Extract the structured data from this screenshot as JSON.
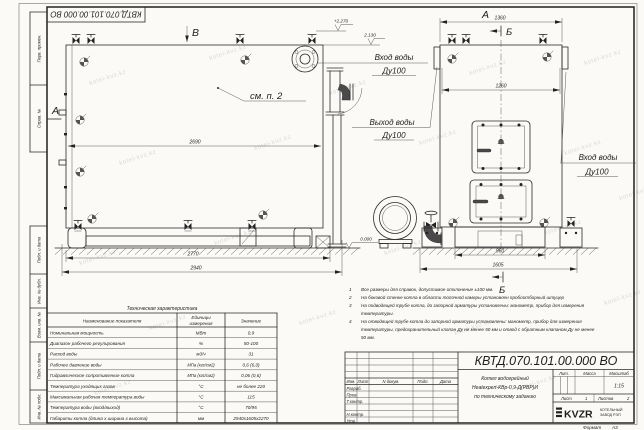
{
  "watermark": {
    "text": "kotel-kvz.kz"
  },
  "stamp_top": "КВТД.070.101.00.000 ВО",
  "margin": {
    "labels": [
      "Перв. примен.",
      "Справ. №",
      "Подп. и дата",
      "Инв. № дубл.",
      "Взам. инв. №",
      "Подп. и дата",
      "Инв. № подл."
    ]
  },
  "views": {
    "label_a_left": "А",
    "label_v_top": "В",
    "label_a_right": "А",
    "label_b_top": "Б",
    "label_b_bottom": "Б",
    "see_note": "см. п. 2"
  },
  "levels": {
    "top": "+2.270",
    "inlet": "2.130",
    "ground": "0.000"
  },
  "dims": {
    "d2690": "2690",
    "d2770": "2770",
    "d2940": "2940",
    "d1360": "1360",
    "d1260": "1260",
    "d960": "960",
    "d1605": "1605"
  },
  "ports": {
    "inlet_left": {
      "line1": "Вход воды",
      "line2": "Ду100"
    },
    "outlet": {
      "line1": "Выход воды",
      "line2": "Ду100"
    },
    "inlet_right": {
      "line1": "Вход воды",
      "line2": "Ду100"
    }
  },
  "notes": {
    "items": [
      {
        "num": "1",
        "lines": [
          "Все размеры для справок, допустимое отклонение ±100 мм."
        ]
      },
      {
        "num": "2",
        "lines": [
          "На боковой стенке котла в области топочной камеры установлен пробоотборный штуцер"
        ]
      },
      {
        "num": "3",
        "lines": [
          "На  подводящей трубе котла, до запорной арматуры установлены: манометр, прибор для измерения",
          "температуры."
        ]
      },
      {
        "num": "4",
        "lines": [
          "На отводящей трубе котла до запорной арматуры установлены: манометр, прибор для измерения",
          "температуры, предохранительный клапан Ду не менее 50 мм и отвод с обратным клапаном Ду не менее",
          "50 мм."
        ]
      }
    ]
  },
  "tech_table": {
    "title": "Техническая характеристика",
    "headers": {
      "name": "Наименование показателя",
      "units_1": "Единицы",
      "units_2": "измерения",
      "value": "Значение"
    },
    "rows": [
      {
        "name": "Номинальная мощность",
        "units": "МВт",
        "value": "0,9"
      },
      {
        "name": "Диапазон рабочего регулирования",
        "units": "%",
        "value": "50-100"
      },
      {
        "name": "Расход воды",
        "units": "м3/ч",
        "value": "31"
      },
      {
        "name": "Рабочее давление воды",
        "units": "МПа (кгс/см2)",
        "value": "0,6 (6,0)"
      },
      {
        "name": "Гидравлическое сопротивление котла",
        "units": "МПа (кгс/см2)",
        "value": "0,06 (0,6)"
      },
      {
        "name": "Температура уходящих газов",
        "units": "°С",
        "value": "не более 220"
      },
      {
        "name": "Максимальная рабочая температура воды",
        "units": "°С",
        "value": "115"
      },
      {
        "name": "Температура воды (вход/выход)",
        "units": "°С",
        "value": "70/95"
      },
      {
        "name": "Габариты котла (длина х ширина х высота)",
        "units": "мм",
        "value": "2940х1605х2270"
      }
    ]
  },
  "title_block": {
    "doc_number": "КВТД.070.101.00.000 ВО",
    "title_lines": [
      "Котел водогрейный",
      "Heatexpert-КВр-0,9-Д(РВР)И",
      "по техническому заданию"
    ],
    "cols": {
      "izm": "Изм.",
      "list": "Лист",
      "doc": "N докум.",
      "podp": "Подп.",
      "data": "Дата"
    },
    "rows": {
      "razrab": "Разраб.",
      "prov": "Пров.",
      "tkontr": "Т.контр.",
      "nkontr": "Н.контр.",
      "utv": "Утв."
    },
    "lit": "Лит.",
    "massa": "Масса",
    "scale_label": "Масштаб",
    "scale": "1:15",
    "sheet_label": "Лист",
    "sheet": "1",
    "sheets_label": "Листов",
    "sheets": "2",
    "logo": "KVZR",
    "logo_sub1": "КОТЕЛЬНЫЙ",
    "logo_sub2": "ЗАВОД РЭП"
  },
  "format": {
    "label": "Формат",
    "value": "А3"
  }
}
